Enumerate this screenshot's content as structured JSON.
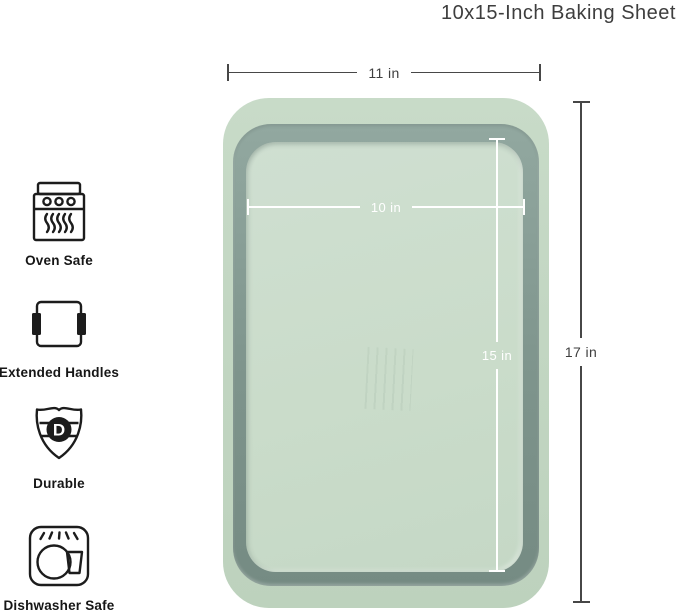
{
  "title": "10x15-Inch Baking Sheet",
  "dimensions": {
    "outer_width": "11 in",
    "outer_length": "17 in",
    "inner_width": "10 in",
    "inner_length": "15 in"
  },
  "features": [
    {
      "icon": "oven-icon",
      "label": "Oven Safe"
    },
    {
      "icon": "extended-handles-icon",
      "label": "Extended Handles"
    },
    {
      "icon": "durable-shield-icon",
      "label": "Durable"
    },
    {
      "icon": "dishwasher-icon",
      "label": "Dishwasher Safe"
    }
  ],
  "shield_letter": "D",
  "colors": {
    "background": "#ffffff",
    "pan_rim": "#c2d6c2",
    "pan_band": "#7e948c",
    "pan_well": "#cadcca",
    "dimension_line_dark": "#474747",
    "dimension_line_light": "#ffffff",
    "icon_stroke": "#1c1c1c",
    "title_text": "#3e3e3e"
  }
}
